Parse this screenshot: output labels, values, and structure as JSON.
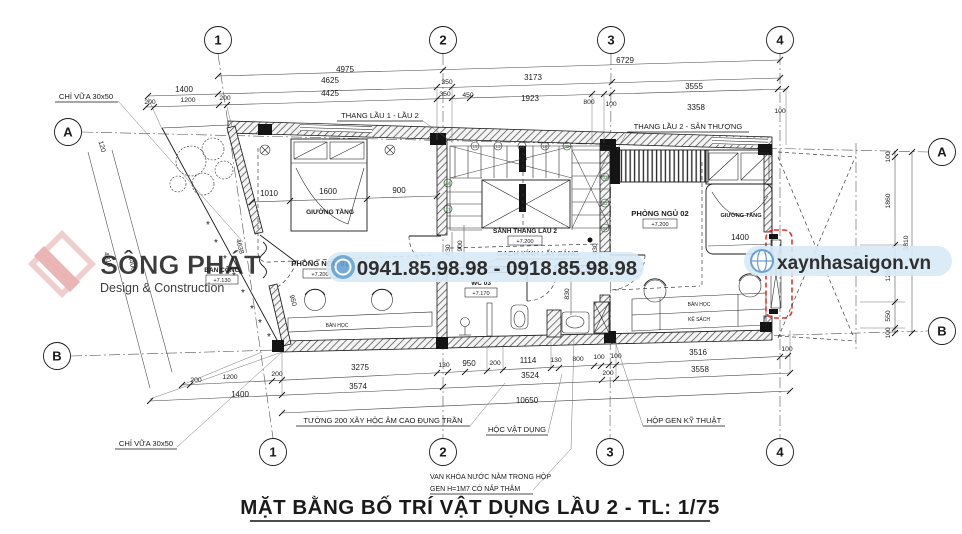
{
  "title": "MẶT BẰNG BỐ TRÍ VẬT DỤNG LẦU 2 - TL: 1/75",
  "grid": {
    "c1": "1",
    "c2": "2",
    "c3": "3",
    "c4": "4",
    "a": "A",
    "b": "B"
  },
  "labels": {
    "chi_vua": "CHỈ VỮA 30x50",
    "thang_1_2": "THANG LẦU 1 - LẦU 2",
    "thang_2_st": "THANG LẦU 2 - SÂN THƯỢNG",
    "tuong_200": "TƯỜNG 200 XÂY HỘC ÂM CAO ĐỤNG TRẦN",
    "hoc_vat_dung": "HỘC VẬT DỤNG",
    "hop_gen": "HỘP GEN KỸ THUẬT",
    "van_khoa_1": "VAN KHÓA NƯỚC NẰM TRONG HỘP",
    "van_khoa_2": "GEN H=1M7 CÓ NẮP THĂM",
    "gach_kinh": "GẠCH KÍNH LẤY SÁNG",
    "ban_cong": "BAN CÔNG",
    "pn01": "PHÒNG NGỦ 01",
    "pn02": "PHÒNG NGỦ 02",
    "wc03": "WC 03",
    "sanh": "SẢNH THANG LẦU 2",
    "giuong_tang": "GIƯỜNG TẦNG",
    "ban_hoc": "BÀN HỌC",
    "ke_sach": "KỆ SÁCH"
  },
  "levels": {
    "main": "+7.200",
    "wc": "+7.170",
    "balcony": "+7.130"
  },
  "dims": {
    "4975": "4975",
    "6729": "6729",
    "1400": "1400",
    "4625": "4625",
    "350": "350",
    "3173": "3173",
    "3555": "3555",
    "200": "200",
    "1200": "1200",
    "4425": "4425",
    "450": "450",
    "1923": "1923",
    "800": "800",
    "100": "100",
    "3358": "3358",
    "1010": "1010",
    "1600": "1600",
    "900": "900",
    "830": "830",
    "120": "120",
    "4400": "4400",
    "4810": "4810",
    "4638": "4638",
    "950": "950",
    "1114": "1114",
    "130": "130",
    "3275": "3275",
    "3574": "3574",
    "3524": "3524",
    "3516": "3516",
    "3558": "3558",
    "10650": "10650",
    "1860": "1860",
    "550": "550",
    "3810": "3810"
  },
  "steps": {
    "s15": "15",
    "s13": "13",
    "s11": "11",
    "s10": "10",
    "s09": "09",
    "s16": "16",
    "s17": "17",
    "s03": "03",
    "s02": "02",
    "s01": "01"
  },
  "watermark": {
    "brand": "SÔNG PHÁT",
    "brand_sub": "Design & Construction",
    "phone": "0941.85.98.98 - 0918.85.98.98",
    "website": "xaynhasaigon.vn"
  }
}
